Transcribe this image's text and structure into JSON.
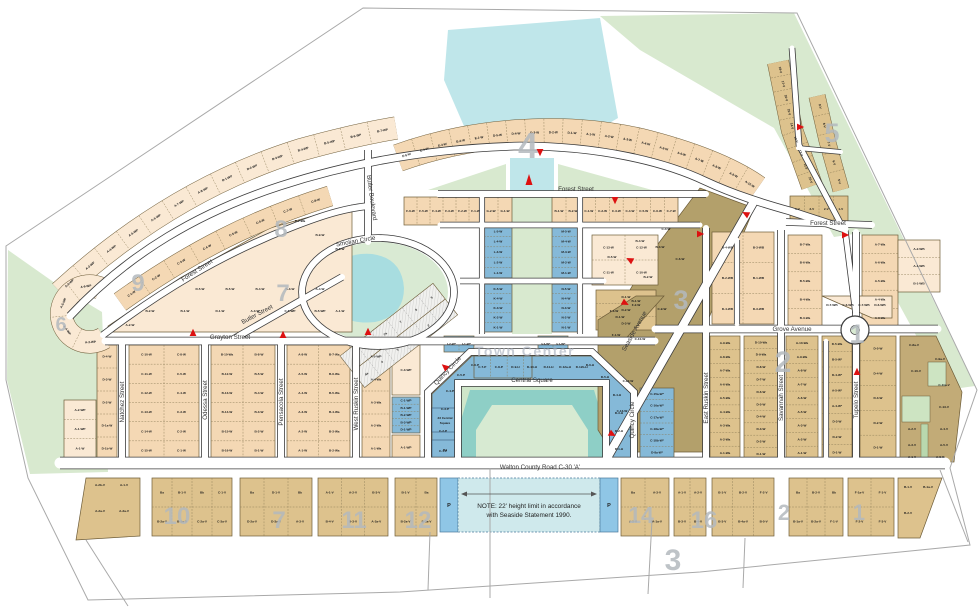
{
  "map": {
    "note": {
      "line1": "NOTE: 22' height limit in accordance",
      "line2": "with Seaside Statement 1990."
    },
    "road_label": "Walton County Road C-30 'A'",
    "landmarks": {
      "town_center": "Town Center",
      "central_square": "Central Square",
      "central_square_lot_1": "23 Central",
      "central_square_lot_2": "Square",
      "lot_b4": "B4",
      "parking": "P"
    },
    "streets": {
      "forest": "Forest Street",
      "grayton": "Grayton Street",
      "natchez": "Natchez Street",
      "odessa": "Odessa Street",
      "pensacola": "Pensacola Street",
      "west_ruskin": "West Ruskin Street",
      "butler_blvd": "Butler Boulevard",
      "butler_st": "Butler Street",
      "smolian": "Smolian Circle",
      "quincy": "Quincy Circle",
      "seaside_ave": "Seaside Avenue",
      "grove": "Grove Avenue",
      "east_ruskin": "East Ruskin Street",
      "savannah": "Savannah Street",
      "tupelo": "Tupelo Street"
    },
    "sections": [
      {
        "n": "4"
      },
      {
        "n": "5"
      },
      {
        "n": "8"
      },
      {
        "n": "7"
      },
      {
        "n": "9"
      },
      {
        "n": "6"
      },
      {
        "n": "3"
      },
      {
        "n": "2"
      },
      {
        "n": "1"
      },
      {
        "n": "10"
      },
      {
        "n": "7"
      },
      {
        "n": "11"
      },
      {
        "n": "12"
      },
      {
        "n": "14"
      },
      {
        "n": "16"
      },
      {
        "n": "2"
      },
      {
        "n": "1"
      },
      {
        "n": "3"
      }
    ],
    "colors": {
      "peach": "#f4d8b4",
      "peach_light": "#fae9d4",
      "tan": "#ddc28d",
      "olive": "#b3a06b",
      "olive2": "#c2ab77",
      "blue": "#85b9d8",
      "blue_strip": "#8fc6e6",
      "note_fill": "#cfe9ec",
      "park": "#d8e9cf",
      "water": "#bfe6ea",
      "lagoon": "#8ecfc6",
      "street_case": "#3c3c3c",
      "section_gray": "#b3b9be",
      "arrow_red": "#dd1111"
    },
    "lots": {
      "band_nw_outer": [
        "A-2-WP",
        "A-3-WP",
        "A-4-WP",
        "A-5-WP",
        "A-6-WP",
        "A-7-WP",
        "A-8-WP",
        "B-1-WP",
        "B-2-WP",
        "B-3-WP",
        "B-4-WP",
        "B-5-WP",
        "B-6-WP",
        "B-7-WP"
      ],
      "band_nw_inner": [
        "C-1-W",
        "C-2-W",
        "C-3-W",
        "C-4-W",
        "C-5-W",
        "C-6-W",
        "C-7-W",
        "C-8-W"
      ],
      "band_sec4": [
        "E-5-W",
        "E-4-W",
        "E-3-W",
        "E-2-W",
        "E-1-W",
        "D-5-W",
        "D-4-W",
        "D-3-W",
        "D-2-W",
        "D-1-W",
        "A-1-W",
        "A-2-W",
        "A-3-W",
        "A-4-W",
        "A-5-W",
        "A-6-W",
        "A-7-W",
        "A-8-W",
        "A-9-W",
        "A-10-W"
      ],
      "band_sec5_a": [
        "18-V",
        "17-V",
        "16-V",
        "15-V",
        "14-V",
        "13-V",
        "12-V",
        "11-V",
        "10-V"
      ],
      "band_sec5_b": [
        "9-V",
        "8-V",
        "7-V",
        "6-V",
        "5-V"
      ],
      "sec5_bottom": [
        "4-V",
        "3-V",
        "2-V",
        "1-V"
      ],
      "loop_fan": [
        "A-6-WP",
        "A-5-WP",
        "A-4-WP",
        "A-3-WP"
      ],
      "corner_sw": [
        "A-2-WP",
        "A-1-WP",
        "A-1-W"
      ],
      "sec7_grid": [
        "D-7-Wa",
        "B-9-W",
        "B-8-W",
        "D-5-W",
        "B-5-W",
        "B-4-W",
        "B-3-W",
        "A-4-W",
        "B-2-W",
        "B-1-W",
        "D-1-W",
        "A-3-W",
        "C-5-WP",
        "B-5-WP",
        "A-2-W",
        "A-1-W"
      ],
      "west0": [
        "D-4-W",
        "D-3-W",
        "D-2-W",
        "D-1a-W",
        "D-1b-W"
      ],
      "west1": [
        "C-10-W",
        "C-8-W",
        "C-11-W",
        "C-5-W",
        "C-12-W",
        "C-4-W",
        "C-13-W",
        "C-3-W",
        "C-14-W",
        "C-2-W",
        "C-15-W",
        "C-1-W"
      ],
      "west2": [
        "B-10-Wa",
        "B-8-W",
        "B-12-W",
        "B-5-W",
        "B-13-W",
        "B-4-W",
        "B-14-W",
        "B-3-W",
        "B-15-W",
        "B-2-W",
        "B-16-W",
        "B-1-W"
      ],
      "west3": [
        "A-8-W",
        "B-7-Wa",
        "A-5-W",
        "B-6-Wa",
        "A-4-W",
        "B-5-Wa",
        "A-3-W",
        "B-4-Wa",
        "A-2-W",
        "B-3-Wa",
        "A-1-W",
        "B-2-Wa"
      ],
      "west4": [
        "A-5-WP",
        "A-4-Wa",
        "A-3-Wa",
        "A-2-Wa",
        "A-1-Wa"
      ],
      "west4b": [
        "C-3-WP"
      ],
      "west4c": [
        "C-1-WP",
        "B-1-WP",
        "B-2-WP",
        "B-3-WP",
        "D-1-WP"
      ],
      "west4d": [
        "A-1-WP"
      ],
      "tc_left": [
        "C-1-P",
        "C-2-P",
        "C-3-P",
        "C-4-P",
        "C-5-P",
        "C-6-P"
      ],
      "tc_top": [
        "C-7-P",
        "C-8-P",
        "D-9-H",
        "D-10-H",
        "D-11-H",
        "D-12a-H",
        "D-12b-H"
      ],
      "tc_right": [
        "D-1-H",
        "D-2-H",
        "D-3-H",
        "D-4-H",
        "D-5-H",
        "D-6-H"
      ],
      "tc_east_col": [
        "C-15a-W*",
        "C-16a-W*",
        "C-17a-W*",
        "C-18a-W*",
        "C-18b-W*",
        "D-8a-W*"
      ],
      "axis_L": [
        "L-5-W",
        "L-4-W",
        "L-3-W",
        "L-2-W",
        "L-1-W"
      ],
      "axis_K": [
        "K-5-W",
        "K-4-W",
        "K-3-W",
        "K-2-W",
        "K-1-W"
      ],
      "axis_M": [
        "M-5-W",
        "M-4-W",
        "M-3-W",
        "M-2-W",
        "M-1-W"
      ],
      "axis_N": [
        "N-5-W",
        "N-4-W",
        "N-3-W",
        "N-2-W",
        "N-1-W"
      ],
      "axis_I": [
        "I-2-W*",
        "I-1-W*"
      ],
      "axis_J": [
        "J-2-W*",
        "J-1-W*"
      ],
      "axis_top_f": [
        "F-6-W",
        "F-5-W",
        "F-4-W",
        "F-3-W",
        "F-2-W",
        "F-1-W"
      ],
      "axis_top_g": [
        "G-2-W",
        "G-1-W"
      ],
      "axis_top_b": [
        "B-1-W",
        "B-2-W"
      ],
      "axis_top_c": [
        "C-1-W",
        "C-2-W",
        "C-3-W",
        "C-4-W",
        "C-5-W",
        "C-6-W",
        "C-7-W"
      ],
      "axis_c_block": [
        "C-13-W",
        "C-12-W",
        "C-11-W",
        "C-10-W"
      ],
      "axis_d_block": [
        "D-1-W",
        "D-2-W",
        "D-3-W"
      ],
      "axis_f_olive": [
        "F-3-W",
        "F-2-W",
        "F-1-W"
      ],
      "smolian_a": [
        "9",
        "8",
        "7a",
        "7",
        "6",
        "5"
      ],
      "smolian_b": [
        "4a",
        "4",
        "3",
        "2a",
        "2",
        "1"
      ],
      "olive_band": [
        "D-5-W",
        "B-4-W",
        "B-3-W",
        "B-2-W",
        "B-1-W",
        "D-1-W",
        "C-4-W",
        "C-6-W",
        "C-9-W",
        "C-10-W",
        "C-12-W",
        "C-13-W"
      ],
      "ne_upper1": [
        "B-4-WB",
        "B-3-WB",
        "B-2-WB",
        "B-1-WB",
        "D-4-WB",
        "D-3-WB"
      ],
      "ne_alley_w": [
        "B-7-Wa",
        "B-6-Wa",
        "B-5-Wa",
        "B-4-Wa",
        "B-3-Wa"
      ],
      "ne_alley_e": [
        "A-7-Wa",
        "A-6-Wa",
        "A-5-Wa",
        "A-4-Wa",
        "A-3-Wa"
      ],
      "ne_fan": [
        "D-7-WB",
        "C-6-WB",
        "C-7-WB",
        "D-6-WB"
      ],
      "ne_topright": [
        "A-2-WB",
        "A-1-WB",
        "B-1-WB"
      ],
      "ne_c1": [
        "A-9-Wa",
        "A-8-Wa",
        "A-7-Wa",
        "A-6-Wa",
        "A-5-Wa",
        "A-4-Wa",
        "A-3-Wa",
        "A-2-Wa",
        "A-1-Wa"
      ],
      "ne_c2": [
        "D-10-Wa",
        "D-9-Wa",
        "D-8-W",
        "D-7-W",
        "D-6-W",
        "D-5-W",
        "D-4-W",
        "D-3-W",
        "D-2-W",
        "D-1-W"
      ],
      "ne_c3": [
        "A-10-Wa",
        "A-9-Wa",
        "A-8-W",
        "A-7-W",
        "A-6-W",
        "A-5-W",
        "A-3-W",
        "A-2-W",
        "A-1-W"
      ],
      "ne_c4": [
        "D-5-Wa",
        "B-5-W*",
        "D-4-W*",
        "A-5-W*",
        "A-4-W*",
        "D-3-W",
        "D-2-W",
        "D-1-W"
      ],
      "ne_c5": [
        "D-5-W",
        "D-4-W",
        "D-3-W",
        "D-2-W",
        "D-1-W"
      ],
      "right_olive": [
        "C-8a-V",
        "C-9a-V",
        "C-10-V",
        "C-11a-V",
        "C-13-V",
        "A-2-V",
        "A-4-V",
        "A-3-V",
        "A-5-V",
        "A-1-V",
        "A-6-V"
      ],
      "bb0": [
        "A-2b-V",
        "A-1-V",
        "A-2a-V",
        "A-3a-V"
      ],
      "bb1": [
        "Ba",
        "B-1-V",
        "Bb",
        "C-1-V",
        "B-2a-V",
        "B-3a-V",
        "C-2a-V",
        "C-3a-V"
      ],
      "bb2": [
        "Ba",
        "D-1-V",
        "Bb",
        "D-2a-V",
        "D-3a-V",
        "A-3-V"
      ],
      "bb3": [
        "A-1-V",
        "A-2-V",
        "B-3-V",
        "B-4-V",
        "D-3-V",
        "A-2a-V"
      ],
      "bb4": [
        "B-1-V",
        "Ba",
        "B-2a-V",
        "B-3a-V"
      ],
      "bb5": [
        "Ba",
        "A-3-V",
        "A-5-V",
        "A-1a-V",
        "A-2a-V",
        "A-3a-V",
        "A-4a-V",
        "A-3-V"
      ],
      "bb6": [
        "A-1-V",
        "A-2-V",
        "B-3-V",
        "B-4-V"
      ],
      "bb7": [
        "B-1-V",
        "B-2-V",
        "F-2-V",
        "B-3-V",
        "B-4a-V",
        "B-5-V",
        "F-1a-V",
        "F-2-V"
      ],
      "bb8": [
        "Ba",
        "B-2-V",
        "Bb",
        "B-1a-V",
        "B-2a-V",
        "F-1-V"
      ],
      "bb9": [
        "F-1a-V",
        "F-1-V",
        "F-2-V",
        "F-3-V"
      ],
      "bb10": [
        "B-1-V",
        "B-1a-V",
        "B-2-V"
      ]
    }
  }
}
